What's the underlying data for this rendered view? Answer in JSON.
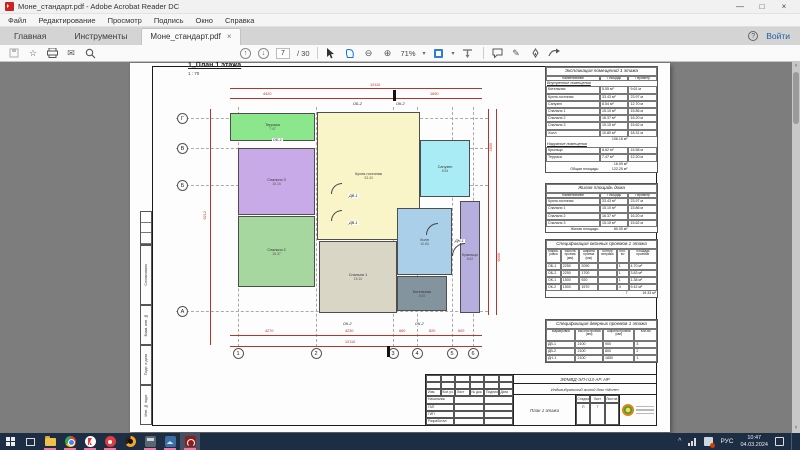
{
  "window": {
    "title": "Моне_стандарт.pdf - Adobe Acrobat Reader DC"
  },
  "glyphs": {
    "minimize": "—",
    "maximize": "□",
    "close": "×",
    "tab_close": "×",
    "help": "?",
    "star": "☆",
    "envelope": "✉",
    "arrow_up": "↑",
    "arrow_down": "↓",
    "zoom_out": "⊖",
    "zoom_in": "⊕",
    "caret_down": "▾",
    "pencil": "✎",
    "scroll_up": "˄",
    "scroll_down": "˅",
    "tray_chevron": "^"
  },
  "menu": {
    "items": [
      "Файл",
      "Редактирование",
      "Просмотр",
      "Подпись",
      "Окно",
      "Справка"
    ]
  },
  "tabs": {
    "home": "Главная",
    "tools": "Инструменты",
    "doc": "Моне_стандарт.pdf",
    "signin": "Войти"
  },
  "toolbar": {
    "page_current": "7",
    "page_total": "/ 30",
    "zoom_level": "71%"
  },
  "plan": {
    "sheet_title": "1_План 1 этажа",
    "sheet_scale": "1 : 70",
    "grid_rows": [
      {
        "label": "Г",
        "y": 55
      },
      {
        "label": "В",
        "y": 85
      },
      {
        "label": "Б",
        "y": 122
      },
      {
        "label": "А",
        "y": 248
      }
    ],
    "grid_cols": [
      {
        "label": "1",
        "x": 108
      },
      {
        "label": "2",
        "x": 186
      },
      {
        "label": "3",
        "x": 263
      },
      {
        "label": "4",
        "x": 287
      },
      {
        "label": "5",
        "x": 322
      },
      {
        "label": "6",
        "x": 343
      }
    ],
    "rooms": [
      {
        "name": "Терраса",
        "area": "7.47",
        "x": 100,
        "y": 50,
        "w": 85,
        "h": 28,
        "color": "#8ce68c"
      },
      {
        "name": "Спальня 3",
        "area": "15.15",
        "x": 108,
        "y": 85,
        "w": 77,
        "h": 67,
        "color": "#c9aae8"
      },
      {
        "name": "Спальня 2",
        "area": "16.37",
        "x": 108,
        "y": 153,
        "w": 77,
        "h": 71,
        "color": "#a5d79f"
      },
      {
        "name": "Кухня-гостиная",
        "area": "33.43",
        "x": 187,
        "y": 49,
        "w": 103,
        "h": 128,
        "color": "#faf5c8"
      },
      {
        "name": "Спальня 1",
        "area": "15.10",
        "x": 189,
        "y": 178,
        "w": 78,
        "h": 72,
        "color": "#d9d6c6"
      },
      {
        "name": "Санузел",
        "area": "8.54",
        "x": 290,
        "y": 77,
        "w": 50,
        "h": 57,
        "color": "#a9ecf5"
      },
      {
        "name": "Холл",
        "area": "10.80",
        "x": 267,
        "y": 145,
        "w": 55,
        "h": 67,
        "color": "#a9cfe9"
      },
      {
        "name": "Котельная",
        "area": "5.55",
        "x": 267,
        "y": 213,
        "w": 50,
        "h": 35,
        "color": "#84949f"
      },
      {
        "name": "Крыльцо",
        "area": "8.62",
        "x": 330,
        "y": 138,
        "w": 20,
        "h": 112,
        "color": "#b5aede"
      }
    ],
    "dim_lines": [
      {
        "x": 100,
        "y": 25,
        "w": 252,
        "h": 1
      },
      {
        "x": 100,
        "y": 35,
        "w": 252,
        "h": 1
      },
      {
        "x": 100,
        "y": 272,
        "w": 252,
        "h": 1
      },
      {
        "x": 100,
        "y": 283,
        "w": 252,
        "h": 1
      },
      {
        "x": 80,
        "y": 46,
        "w": 1,
        "h": 236
      },
      {
        "x": 358,
        "y": 46,
        "w": 1,
        "h": 206
      },
      {
        "x": 366,
        "y": 46,
        "w": 1,
        "h": 206
      }
    ],
    "dim_texts": [
      {
        "t": "12110",
        "x": 240,
        "y": 20
      },
      {
        "t": "4420",
        "x": 133,
        "y": 29
      },
      {
        "t": "1690",
        "x": 300,
        "y": 29
      },
      {
        "t": "4270",
        "x": 135,
        "y": 266
      },
      {
        "t": "4230",
        "x": 215,
        "y": 266
      },
      {
        "t": "660",
        "x": 269,
        "y": 266
      },
      {
        "t": "820",
        "x": 299,
        "y": 266
      },
      {
        "t": "600",
        "x": 328,
        "y": 266
      },
      {
        "t": "12110",
        "x": 215,
        "y": 277
      },
      {
        "t": "9212",
        "x": 73,
        "y": 148,
        "v": true
      },
      {
        "t": "1800",
        "x": 359,
        "y": 80,
        "v": true
      },
      {
        "t": "6000",
        "x": 367,
        "y": 190,
        "v": true
      }
    ],
    "opening_labels": [
      {
        "t": "ОБ-2",
        "x": 222,
        "y": 39
      },
      {
        "t": "ОК-2",
        "x": 265,
        "y": 39
      },
      {
        "t": "ОБ-1",
        "x": 142,
        "y": 75
      },
      {
        "t": "ДВ-1",
        "x": 218,
        "y": 131
      },
      {
        "t": "ДВ-1",
        "x": 218,
        "y": 158
      },
      {
        "t": "ДН-1",
        "x": 324,
        "y": 176
      },
      {
        "t": "ОК-2",
        "x": 212,
        "y": 259
      },
      {
        "t": "ОК-2",
        "x": 284,
        "y": 259
      }
    ],
    "section_flags": [
      {
        "x": 263,
        "y": 27,
        "w": 2.5,
        "h": 11
      },
      {
        "x": 257,
        "y": 283,
        "w": 2.5,
        "h": 11
      }
    ],
    "door_arcs": [
      {
        "x": 201,
        "y": 120,
        "r": 11
      },
      {
        "x": 201,
        "y": 147,
        "r": 11
      },
      {
        "x": 296,
        "y": 160,
        "r": 12
      },
      {
        "x": 322,
        "y": 180,
        "r": 13
      }
    ]
  },
  "tables": {
    "explication": {
      "title": "Экспликация помещений 1 этажа",
      "columns": [
        "Наименование",
        "Площадь",
        "Периметр"
      ],
      "section1": "Внутренние помещения",
      "rows1": [
        [
          "Котельная",
          "5.55 м²",
          "9.61 м"
        ],
        [
          "Кухня-гостиная",
          "33.43 м²",
          "23.97 м"
        ],
        [
          "Санузел",
          "8.54 м²",
          "12.70 м"
        ],
        [
          "Спальня 1",
          "15.10 м²",
          "15.86 м"
        ],
        [
          "Спальня 2",
          "16.37 м²",
          "16.20 м"
        ],
        [
          "Спальня 3",
          "15.15 м²",
          "15.62 м"
        ],
        [
          "Холл",
          "10.80 м²",
          "18.31 м"
        ]
      ],
      "subtotal1": "106.16 м²",
      "section2": "Наружные помещения",
      "rows2": [
        [
          "Крыльцо",
          "8.62 м²",
          "15.58 м"
        ],
        [
          "Терраса",
          "7.47 м²",
          "12.20 м"
        ]
      ],
      "subtotal2": "16.09 м²",
      "total_label": "Общая площадь:",
      "total": "122.25 м²"
    },
    "living": {
      "title": "Жилая площадь дома",
      "columns": [
        "Наименование",
        "Площадь",
        "Периметр"
      ],
      "rows": [
        [
          "Кухня-гостиная",
          "33.43 м²",
          "23.97 м"
        ],
        [
          "Спальня 1",
          "15.10 м²",
          "15.86 м"
        ],
        [
          "Спальня 2",
          "16.37 м²",
          "16.20 м"
        ],
        [
          "Спальня 3",
          "15.15 м²",
          "15.62 м"
        ]
      ],
      "total_label": "Жилая площадь:",
      "total": "80.05 м²"
    },
    "windows_spec": {
      "title": "Спецификация оконных проемов 1 этажа",
      "columns": [
        "Марки- ровка",
        "Высота проема (мм)",
        "Ширина проема (мм)",
        "Контур витража",
        "Кол- во",
        "Площадь проемов"
      ],
      "rows": [
        [
          "ОБ-1",
          "2250",
          "2090",
          "",
          "1",
          "4.70 м²"
        ],
        [
          "ОБ-2",
          "2250",
          "1700",
          "",
          "1",
          "3.83 м²"
        ],
        [
          "ОК-1",
          "1500",
          "920",
          "",
          "1",
          "1.38 м²"
        ],
        [
          "ОК-2",
          "1500",
          "1570",
          "",
          "4",
          "9.42 м²"
        ]
      ],
      "total_count": "7",
      "total_area": "19.33 м²"
    },
    "doors_spec": {
      "title": "Спецификация дверных проемов 1 этажа",
      "columns": [
        "Маркировка",
        "Высота проема (мм)",
        "Ширина проема (мм)",
        "Кол-во"
      ],
      "rows": [
        [
          "ДВ-1",
          "2100",
          "900",
          "3"
        ],
        [
          "ДВ-2",
          "2100",
          "800",
          "2"
        ],
        [
          "ДН-1",
          "2100",
          "1850",
          "1"
        ]
      ]
    }
  },
  "titleblock": {
    "doc_code": "ЗФМВД-ЭП-п13-АР. НР",
    "object": "Индивидуальный жилой дом «Моне»",
    "cols": [
      "Изм.",
      "Кол.уч.",
      "Лист",
      "№ док.",
      "Подпись",
      "Дата"
    ],
    "roles": [
      "Начальник",
      "ГАП",
      "ГИП",
      "Разработал"
    ],
    "sheet_name": "План 1 этажа",
    "stage_label": "Стадия",
    "sheet_label": "Лист",
    "sheets_label": "Листов",
    "stage": "П",
    "sheet_no": "7",
    "sheets_no": ""
  },
  "side_strip": [
    "Согласовано",
    "Взам. инв. №",
    "Подп. и дата",
    "Инв. № подл."
  ],
  "taskbar": {
    "lang": "РУС",
    "time": "10:47",
    "date": "04.03.2024",
    "apps": [
      {
        "id": "file-explorer",
        "cls": "folder",
        "running": true
      },
      {
        "id": "chrome",
        "cls": "cicon chrome",
        "running": true
      },
      {
        "id": "yandex-browser",
        "cls": "cicon ybrowser",
        "running": true
      },
      {
        "id": "red-app",
        "cls": "cicon redapp",
        "running": true
      },
      {
        "id": "orange-app",
        "cls": "cicon orangeapp",
        "running": false
      },
      {
        "id": "calculator-app",
        "cls": "sq calc",
        "running": true
      },
      {
        "id": "blue-app",
        "cls": "sq blueapp",
        "running": true
      },
      {
        "id": "acrobat-reader",
        "cls": "sq acrored",
        "running": true,
        "active": true
      }
    ]
  }
}
